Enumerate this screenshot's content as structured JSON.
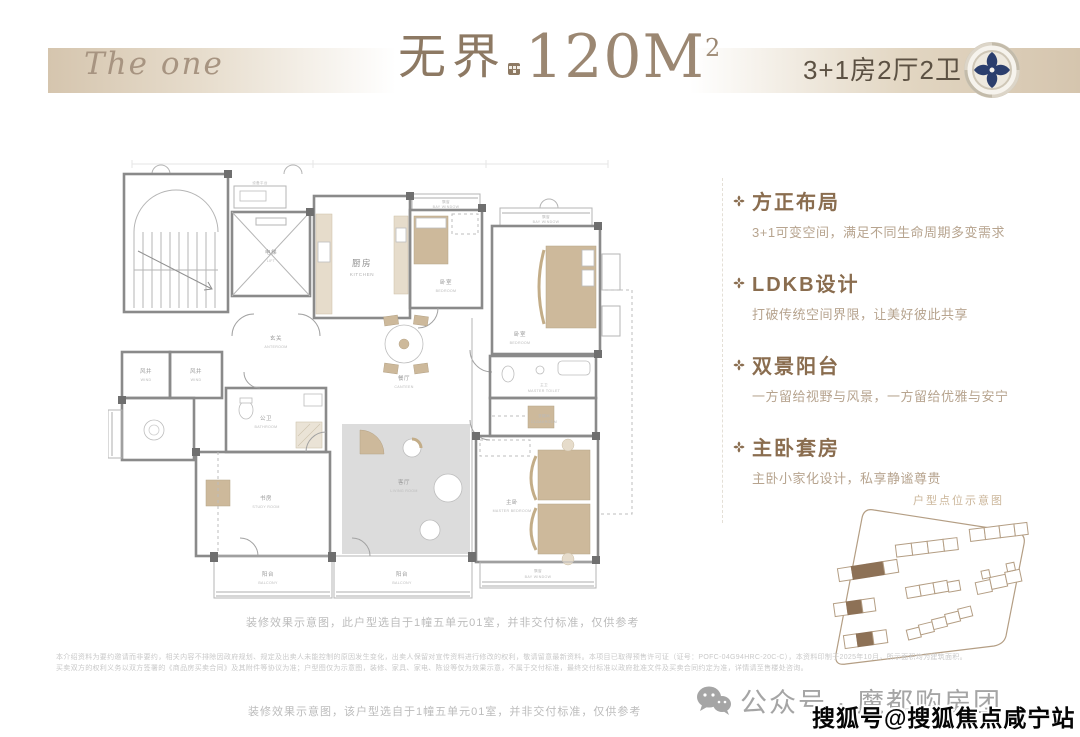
{
  "header": {
    "brand": "The one",
    "title_cn": "无界",
    "area_value": "120M",
    "area_sup": "2",
    "unit_spec": "3+1房2厅2卫"
  },
  "features": [
    {
      "title": "方正布局",
      "desc": "3+1可变空间，满足不同生命周期多变需求"
    },
    {
      "title": "LDKB设计",
      "desc": "打破传统空间界限，让美好彼此共享"
    },
    {
      "title": "双景阳台",
      "desc": "一方留给视野与风景，一方留给优雅与安宁"
    },
    {
      "title": "主卧套房",
      "desc": "主卧小家化设计，私享静谧尊贵"
    }
  ],
  "floorplan": {
    "note": "装修效果示意图，此户型选自于1幢五单元01室，并非交付标准，仅供参考",
    "rooms": {
      "lift": {
        "cn": "电梯",
        "en": "LIFT"
      },
      "equipment": {
        "cn": "设备平台"
      },
      "kitchen": {
        "cn": "厨房",
        "en": "KITCHEN"
      },
      "bedroom_mid": {
        "cn": "卧室",
        "en": "BEDROOM"
      },
      "bedroom_tr": {
        "cn": "卧室",
        "en": "BEDROOM"
      },
      "anteroom": {
        "cn": "玄关",
        "en": "ANTEROOM"
      },
      "wind1": {
        "cn": "风井",
        "en": "WIND"
      },
      "wind2": {
        "cn": "风井",
        "en": "WIND"
      },
      "bath": {
        "cn": "公卫",
        "en": "BATHROOM"
      },
      "dining": {
        "cn": "餐厅",
        "en": "CANTEEN"
      },
      "study": {
        "cn": "书房",
        "en": "STUDY ROOM"
      },
      "living": {
        "cn": "客厅",
        "en": "LIVING ROOM"
      },
      "master_toilet": {
        "cn": "主卫",
        "en": "MASTER TOILET"
      },
      "cloakroom": {
        "cn": "衣帽间",
        "en": "CLOAKROOM"
      },
      "master": {
        "cn": "主卧",
        "en": "MASTER BEDROOM"
      },
      "balcony_left": {
        "cn": "阳台",
        "en": "BALCONY"
      },
      "balcony_right": {
        "cn": "阳台",
        "en": "BALCONY"
      },
      "bay_mid": {
        "cn": "飘窗",
        "en": "BAY WINDOW"
      },
      "bay_tr": {
        "cn": "飘窗",
        "en": "BAY WINDOW"
      },
      "bay_master": {
        "cn": "飘窗",
        "en": "BAY WINDOW"
      }
    }
  },
  "site_plan": {
    "caption": "户型点位示意图"
  },
  "notes": {
    "disclaimer_line1": "本介绍资料为要约邀请而非要约，相关内容不排除因政府规划、规定及出卖人未能控制的原因发生变化，出卖人保留对宣传资料进行修改的权利，敬请留意最新资料。本项目已取得预售许可证（证号：POFC-04G94HRC-20C-C），本资料印制于2025年10月，所示面积均为建筑面积。",
    "disclaimer_line2": "买卖双方的权利义务以双方签署的《商品房买卖合同》及其附件等协议为准；户型图仅为示意图，装修、家具、家电、陈设等仅为效果示意，不属于交付标准，最终交付标准以政府批准文件及买卖合同约定为准，详情请至售楼处咨询。",
    "bottom_note": "装修效果示意图，该户型选自于1幢五单元01室，并非交付标准，仅供参考"
  },
  "watermarks": {
    "wechat": "公众号 · 魔都购房团",
    "sohu": "搜狐号@搜狐焦点咸宁站"
  },
  "colors": {
    "accent_brown": "#8a6d4f",
    "banner_tan": "#d5c5ae",
    "badge_navy": "#2b3e6d",
    "site_highlight": "#8d7156"
  }
}
